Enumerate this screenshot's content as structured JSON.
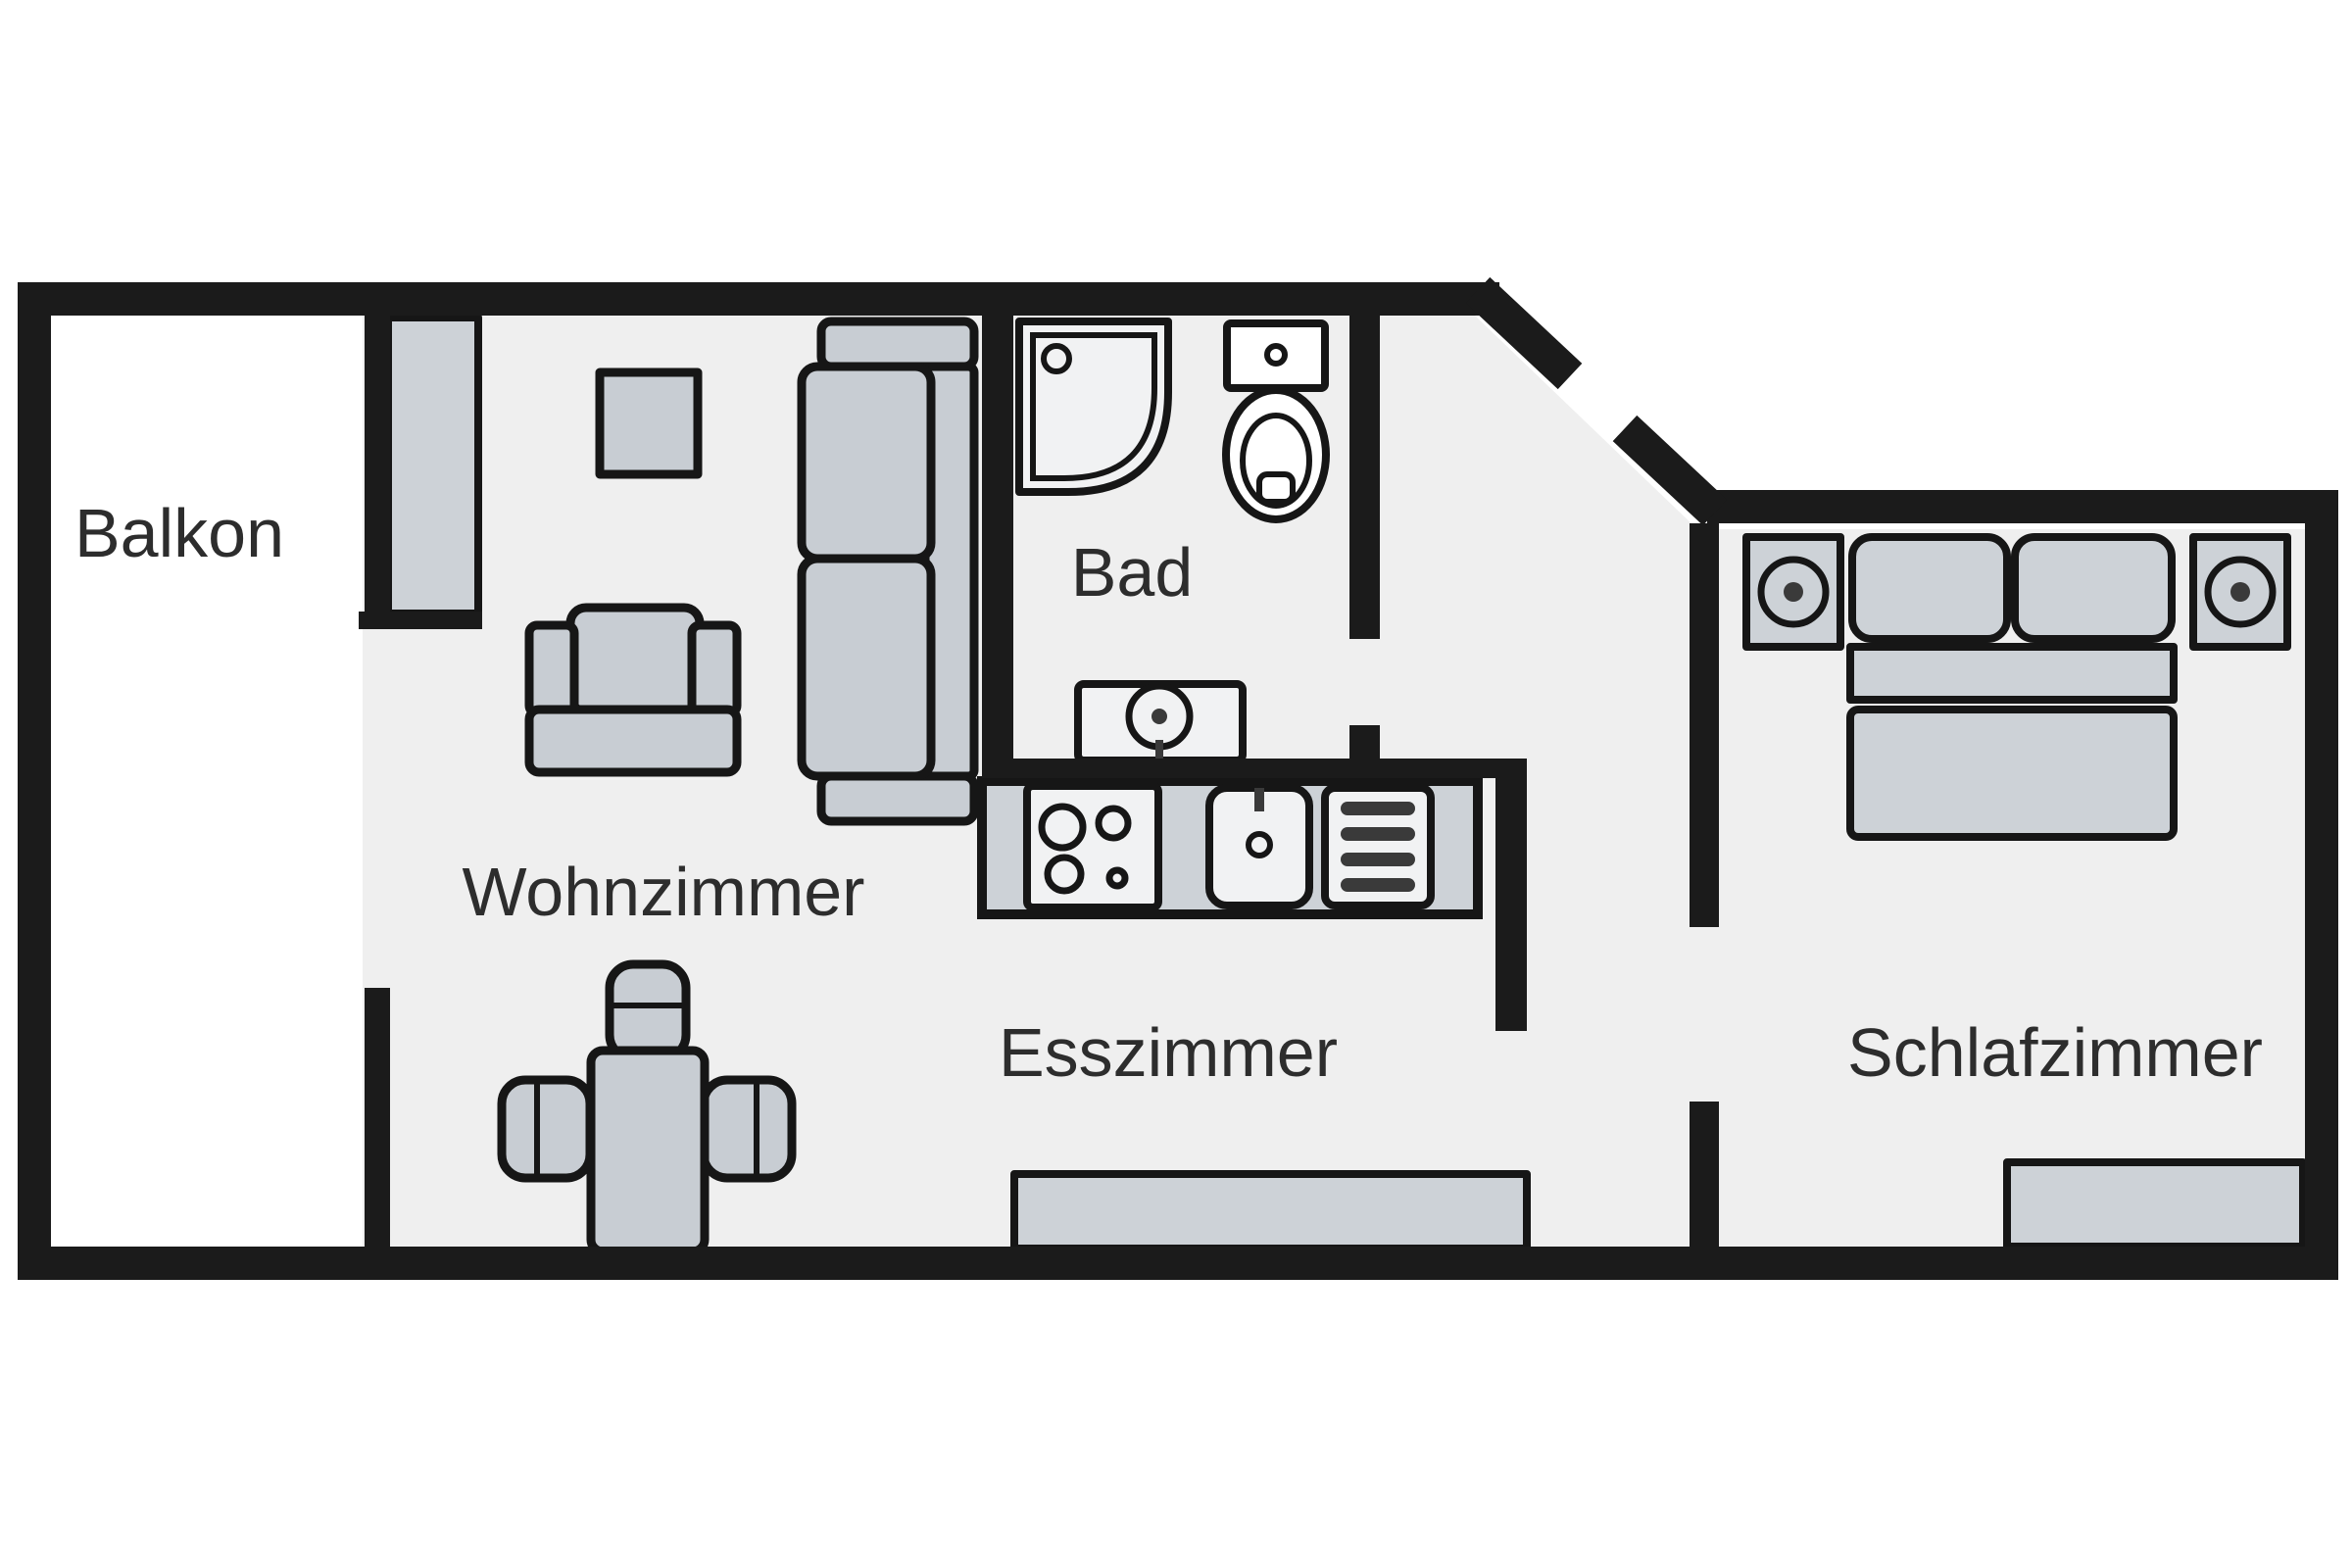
{
  "plan": {
    "type": "apartment-floor-plan",
    "rooms": [
      {
        "id": "balkon",
        "label": "Balkon"
      },
      {
        "id": "wohnzimmer",
        "label": "Wohnzimmer"
      },
      {
        "id": "bad",
        "label": "Bad"
      },
      {
        "id": "esszimmer",
        "label": "Esszimmer"
      },
      {
        "id": "schlafzimmer",
        "label": "Schlafzimmer"
      }
    ],
    "icons": [
      "balcony-door-icon",
      "coffee-table-icon",
      "sofa-icon",
      "armchair-icon",
      "shower-icon",
      "toilet-icon",
      "washbasin-icon",
      "kitchen-counter-icon",
      "stove-icon",
      "kitchen-sink-icon",
      "dishwasher-icon",
      "dining-table-icon",
      "dining-chair-icon",
      "sideboard-icon",
      "double-bed-icon",
      "pillow-icon",
      "nightstand-speaker-icon"
    ]
  },
  "colors": {
    "wall": "#1b1b1b",
    "outline": "#161616",
    "floor": "#efefef",
    "balcony_floor": "#ffffff",
    "furniture": "#c8cdd3",
    "furniture_alt": "#cdd2d7",
    "fixture": "#f1f2f3",
    "fixture_white": "#ffffff",
    "appliance_dark": "#3a3a3a",
    "label_text": "#2d2d2d",
    "background": "#ffffff"
  }
}
